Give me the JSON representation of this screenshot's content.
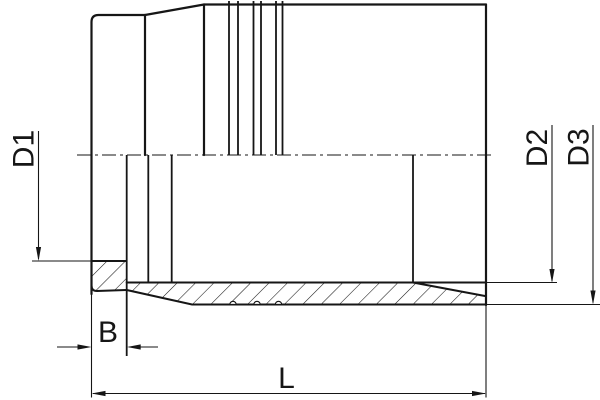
{
  "diagram": {
    "type": "technical-drawing",
    "subject": "pipe-fitting-spigot-cross-section",
    "background_color": "#ffffff",
    "line_color": "#161616",
    "labels": {
      "d1": "D1",
      "d2": "D2",
      "d3": "D3",
      "b": "B",
      "l": "L"
    }
  }
}
